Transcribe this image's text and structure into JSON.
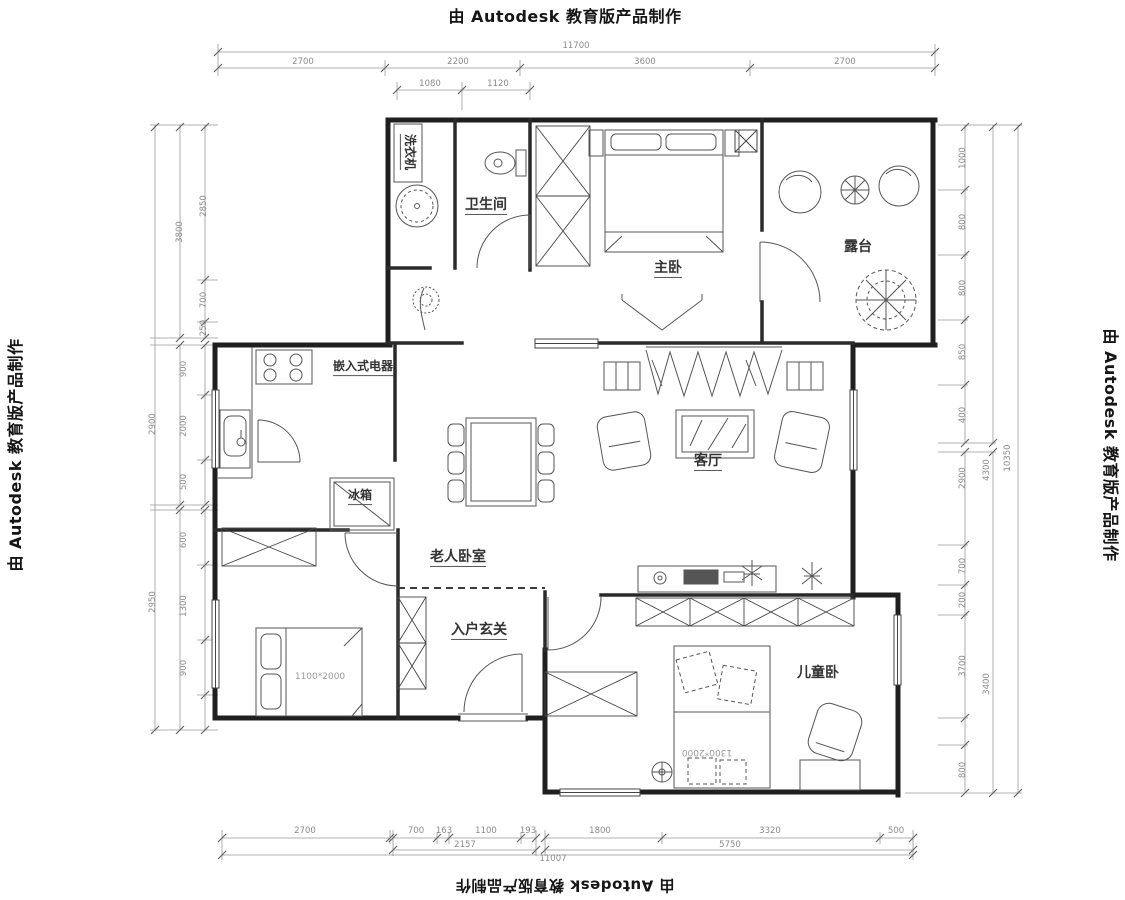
{
  "watermark": {
    "text": "由 Autodesk 教育版产品制作"
  },
  "rooms": {
    "bathroom": {
      "label": "卫生间"
    },
    "washer": {
      "label": "洗衣机"
    },
    "master": {
      "label": "主卧"
    },
    "terrace": {
      "label": "露台"
    },
    "living": {
      "label": "客厅"
    },
    "appliance": {
      "label": "嵌入式电器"
    },
    "fridge": {
      "label": "冰箱"
    },
    "elder": {
      "label": "老人卧室"
    },
    "entry": {
      "label": "入户玄关"
    },
    "kids": {
      "label": "儿童卧"
    },
    "elder_bed_size": {
      "label": "1100*2000"
    },
    "kids_bed_size": {
      "label": "1300*2000"
    }
  },
  "dims": {
    "labels": [
      {
        "t": "11700",
        "x": 576,
        "y": 46,
        "r": 0
      },
      {
        "t": "2700",
        "x": 303,
        "y": 62,
        "r": 0
      },
      {
        "t": "2200",
        "x": 458,
        "y": 62,
        "r": 0
      },
      {
        "t": "3600",
        "x": 645,
        "y": 62,
        "r": 0
      },
      {
        "t": "2700",
        "x": 845,
        "y": 62,
        "r": 0
      },
      {
        "t": "1080",
        "x": 430,
        "y": 84,
        "r": 0
      },
      {
        "t": "1120",
        "x": 498,
        "y": 84,
        "r": 0
      },
      {
        "t": "2700",
        "x": 305,
        "y": 831,
        "r": 0
      },
      {
        "t": "700",
        "x": 416,
        "y": 831,
        "r": 0
      },
      {
        "t": "163",
        "x": 444,
        "y": 831,
        "r": 0
      },
      {
        "t": "1100",
        "x": 486,
        "y": 831,
        "r": 0
      },
      {
        "t": "193",
        "x": 528,
        "y": 831,
        "r": 0
      },
      {
        "t": "1800",
        "x": 600,
        "y": 831,
        "r": 0
      },
      {
        "t": "3320",
        "x": 770,
        "y": 831,
        "r": 0
      },
      {
        "t": "500",
        "x": 896,
        "y": 831,
        "r": 0
      },
      {
        "t": "2157",
        "x": 465,
        "y": 845,
        "r": 0
      },
      {
        "t": "5750",
        "x": 730,
        "y": 845,
        "r": 0
      },
      {
        "t": "11007",
        "x": 553,
        "y": 859,
        "r": 0
      },
      {
        "t": "2850",
        "x": 204,
        "y": 206,
        "r": -90
      },
      {
        "t": "3800",
        "x": 180,
        "y": 232,
        "r": -90
      },
      {
        "t": "700",
        "x": 204,
        "y": 300,
        "r": -90
      },
      {
        "t": "250",
        "x": 204,
        "y": 328,
        "r": -90
      },
      {
        "t": "900",
        "x": 184,
        "y": 369,
        "r": -90
      },
      {
        "t": "2000",
        "x": 184,
        "y": 426,
        "r": -90
      },
      {
        "t": "500",
        "x": 184,
        "y": 482,
        "r": -90
      },
      {
        "t": "2900",
        "x": 153,
        "y": 424,
        "r": -90
      },
      {
        "t": "600",
        "x": 184,
        "y": 540,
        "r": -90
      },
      {
        "t": "1300",
        "x": 184,
        "y": 606,
        "r": -90
      },
      {
        "t": "900",
        "x": 184,
        "y": 668,
        "r": -90
      },
      {
        "t": "2950",
        "x": 153,
        "y": 602,
        "r": -90
      },
      {
        "t": "1000",
        "x": 963,
        "y": 158,
        "r": -90
      },
      {
        "t": "800",
        "x": 963,
        "y": 222,
        "r": -90
      },
      {
        "t": "800",
        "x": 963,
        "y": 288,
        "r": -90
      },
      {
        "t": "850",
        "x": 963,
        "y": 352,
        "r": -90
      },
      {
        "t": "400",
        "x": 963,
        "y": 415,
        "r": -90
      },
      {
        "t": "2900",
        "x": 963,
        "y": 478,
        "r": -90
      },
      {
        "t": "4300",
        "x": 987,
        "y": 470,
        "r": -90
      },
      {
        "t": "10350",
        "x": 1008,
        "y": 458,
        "r": -90
      },
      {
        "t": "700",
        "x": 963,
        "y": 566,
        "r": -90
      },
      {
        "t": "200",
        "x": 963,
        "y": 600,
        "r": -90
      },
      {
        "t": "3700",
        "x": 963,
        "y": 666,
        "r": -90
      },
      {
        "t": "3400",
        "x": 987,
        "y": 684,
        "r": -90
      },
      {
        "t": "800",
        "x": 963,
        "y": 770,
        "r": -90
      }
    ],
    "lines": [
      [
        218,
        52,
        935,
        52
      ],
      [
        218,
        68,
        935,
        68
      ],
      [
        397,
        90,
        530,
        90
      ],
      [
        218,
        44,
        218,
        76
      ],
      [
        385,
        60,
        385,
        76
      ],
      [
        520,
        60,
        520,
        76
      ],
      [
        750,
        60,
        750,
        76
      ],
      [
        935,
        44,
        935,
        76
      ],
      [
        397,
        82,
        397,
        100
      ],
      [
        462,
        82,
        462,
        110
      ],
      [
        530,
        82,
        530,
        100
      ],
      [
        222,
        838,
        390,
        838
      ],
      [
        393,
        838,
        536,
        838
      ],
      [
        545,
        838,
        913,
        838
      ],
      [
        393,
        850,
        536,
        850
      ],
      [
        545,
        850,
        913,
        850
      ],
      [
        222,
        855,
        913,
        855
      ],
      [
        222,
        830,
        222,
        860
      ],
      [
        390,
        830,
        390,
        844
      ],
      [
        393,
        830,
        393,
        856
      ],
      [
        437,
        832,
        437,
        844
      ],
      [
        449,
        832,
        449,
        844
      ],
      [
        521,
        832,
        521,
        844
      ],
      [
        536,
        830,
        536,
        856
      ],
      [
        545,
        830,
        545,
        856
      ],
      [
        662,
        832,
        662,
        844
      ],
      [
        880,
        832,
        880,
        844
      ],
      [
        913,
        830,
        913,
        860
      ],
      [
        155,
        125,
        155,
        730
      ],
      [
        180,
        125,
        180,
        338
      ],
      [
        180,
        345,
        180,
        505
      ],
      [
        180,
        510,
        180,
        730
      ],
      [
        205,
        125,
        205,
        338
      ],
      [
        205,
        345,
        205,
        505
      ],
      [
        205,
        510,
        205,
        730
      ],
      [
        150,
        125,
        218,
        125
      ],
      [
        197,
        280,
        218,
        280
      ],
      [
        197,
        322,
        218,
        322
      ],
      [
        150,
        338,
        218,
        338
      ],
      [
        150,
        345,
        218,
        345
      ],
      [
        197,
        395,
        218,
        395
      ],
      [
        197,
        460,
        218,
        460
      ],
      [
        150,
        505,
        218,
        505
      ],
      [
        150,
        510,
        218,
        510
      ],
      [
        197,
        565,
        218,
        565
      ],
      [
        197,
        640,
        218,
        640
      ],
      [
        197,
        695,
        218,
        695
      ],
      [
        150,
        730,
        218,
        730
      ],
      [
        1018,
        125,
        1018,
        793
      ],
      [
        993,
        125,
        993,
        443
      ],
      [
        993,
        452,
        993,
        793
      ],
      [
        965,
        125,
        965,
        443
      ],
      [
        965,
        452,
        965,
        793
      ],
      [
        938,
        125,
        1022,
        125
      ],
      [
        938,
        190,
        968,
        190
      ],
      [
        938,
        255,
        968,
        255
      ],
      [
        938,
        320,
        968,
        320
      ],
      [
        938,
        385,
        968,
        385
      ],
      [
        938,
        443,
        996,
        443
      ],
      [
        938,
        452,
        996,
        452
      ],
      [
        938,
        545,
        968,
        545
      ],
      [
        938,
        585,
        968,
        585
      ],
      [
        938,
        615,
        968,
        615
      ],
      [
        938,
        718,
        968,
        718
      ],
      [
        938,
        745,
        968,
        745
      ],
      [
        905,
        793,
        1022,
        793
      ]
    ],
    "ticks": [
      [
        218,
        52
      ],
      [
        935,
        52
      ],
      [
        218,
        68
      ],
      [
        385,
        68
      ],
      [
        520,
        68
      ],
      [
        750,
        68
      ],
      [
        935,
        68
      ],
      [
        397,
        90
      ],
      [
        462,
        90
      ],
      [
        530,
        90
      ],
      [
        222,
        838
      ],
      [
        390,
        838
      ],
      [
        393,
        838
      ],
      [
        437,
        838
      ],
      [
        449,
        838
      ],
      [
        521,
        838
      ],
      [
        536,
        838
      ],
      [
        545,
        838
      ],
      [
        662,
        838
      ],
      [
        880,
        838
      ],
      [
        913,
        838
      ],
      [
        393,
        850
      ],
      [
        536,
        850
      ],
      [
        545,
        850
      ],
      [
        913,
        850
      ],
      [
        222,
        855
      ],
      [
        913,
        855
      ],
      [
        205,
        127
      ],
      [
        205,
        280
      ],
      [
        205,
        322
      ],
      [
        205,
        338
      ],
      [
        205,
        345
      ],
      [
        205,
        395
      ],
      [
        205,
        460
      ],
      [
        205,
        505
      ],
      [
        205,
        510
      ],
      [
        205,
        565
      ],
      [
        205,
        640
      ],
      [
        205,
        695
      ],
      [
        205,
        730
      ],
      [
        180,
        127
      ],
      [
        180,
        338
      ],
      [
        180,
        345
      ],
      [
        180,
        505
      ],
      [
        180,
        510
      ],
      [
        180,
        730
      ],
      [
        155,
        127
      ],
      [
        155,
        730
      ],
      [
        965,
        127
      ],
      [
        965,
        190
      ],
      [
        965,
        255
      ],
      [
        965,
        320
      ],
      [
        965,
        385
      ],
      [
        965,
        443
      ],
      [
        965,
        452
      ],
      [
        965,
        545
      ],
      [
        965,
        585
      ],
      [
        965,
        615
      ],
      [
        965,
        718
      ],
      [
        965,
        745
      ],
      [
        965,
        793
      ],
      [
        993,
        127
      ],
      [
        993,
        443
      ],
      [
        993,
        452
      ],
      [
        993,
        793
      ],
      [
        1018,
        127
      ],
      [
        1018,
        793
      ]
    ]
  }
}
